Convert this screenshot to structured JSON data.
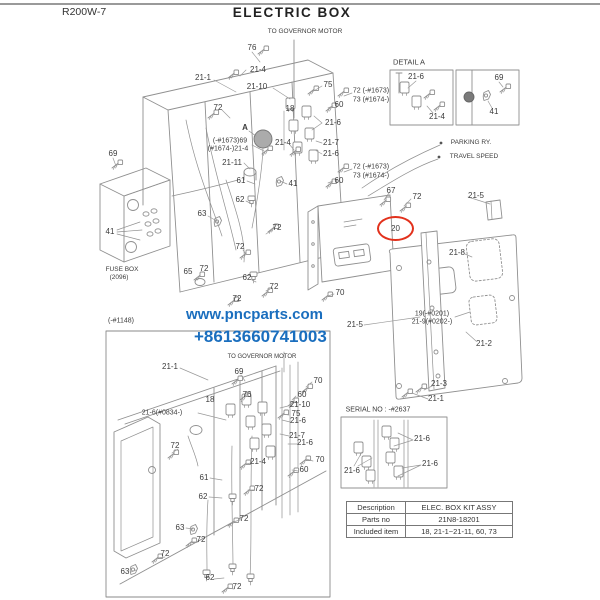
{
  "header": {
    "model": "R200W-7",
    "title": "ELECTRIC BOX"
  },
  "watermark": {
    "line1": "www.pncparts.com",
    "line2": "+8613660741003",
    "color": "#1a6ebe"
  },
  "highlight": {
    "text": "20",
    "color": "#e2311c"
  },
  "table": {
    "rows": [
      {
        "label": "Description",
        "value": "ELEC. BOX KIT ASSY"
      },
      {
        "label": "Parts no",
        "value": "21N8-18201"
      },
      {
        "label": "Included item",
        "value": "18, 21-1~21-11, 60, 73"
      }
    ]
  },
  "callouts": [
    {
      "text": "TO GOVERNOR MOTOR",
      "x": 305,
      "y": 32,
      "size": 6.5
    },
    {
      "text": "76",
      "x": 252,
      "y": 48
    },
    {
      "text": "21-4",
      "x": 258,
      "y": 70
    },
    {
      "text": "21-1",
      "x": 203,
      "y": 78
    },
    {
      "text": "21-10",
      "x": 257,
      "y": 87
    },
    {
      "text": "75",
      "x": 328,
      "y": 85
    },
    {
      "text": "72 (-#1673)",
      "x": 371,
      "y": 91,
      "size": 7
    },
    {
      "text": "73 (#1674-)",
      "x": 371,
      "y": 100,
      "size": 7
    },
    {
      "text": "60",
      "x": 339,
      "y": 105
    },
    {
      "text": "72",
      "x": 218,
      "y": 108
    },
    {
      "text": "18",
      "x": 290,
      "y": 109
    },
    {
      "text": "21-6",
      "x": 333,
      "y": 123
    },
    {
      "text": "A",
      "x": 245,
      "y": 128,
      "bold": true
    },
    {
      "text": "(-#1673)69",
      "x": 230,
      "y": 141,
      "size": 7
    },
    {
      "text": "(#1674-)21-4",
      "x": 228,
      "y": 149,
      "size": 7
    },
    {
      "text": "21-4",
      "x": 283,
      "y": 143
    },
    {
      "text": "21-7",
      "x": 331,
      "y": 143
    },
    {
      "text": "21-6",
      "x": 331,
      "y": 154
    },
    {
      "text": "21-11",
      "x": 232,
      "y": 163
    },
    {
      "text": "DETAIL A",
      "x": 409,
      "y": 62,
      "size": 7.5
    },
    {
      "text": "21-6",
      "x": 416,
      "y": 77
    },
    {
      "text": "21-4",
      "x": 437,
      "y": 117
    },
    {
      "text": "69",
      "x": 499,
      "y": 78
    },
    {
      "text": "41",
      "x": 494,
      "y": 112
    },
    {
      "text": "PARKING RY.",
      "x": 471,
      "y": 143,
      "size": 6.5
    },
    {
      "text": "TRAVEL SPEED",
      "x": 474,
      "y": 157,
      "size": 6.5
    },
    {
      "text": "69",
      "x": 113,
      "y": 154
    },
    {
      "text": "61",
      "x": 241,
      "y": 181
    },
    {
      "text": "41",
      "x": 293,
      "y": 184
    },
    {
      "text": "72 (-#1673)",
      "x": 371,
      "y": 167,
      "size": 7
    },
    {
      "text": "73 (#1674-)",
      "x": 371,
      "y": 176,
      "size": 7
    },
    {
      "text": "60",
      "x": 339,
      "y": 181
    },
    {
      "text": "67",
      "x": 391,
      "y": 191
    },
    {
      "text": "72",
      "x": 417,
      "y": 197
    },
    {
      "text": "21-5",
      "x": 476,
      "y": 196
    },
    {
      "text": "62",
      "x": 240,
      "y": 200
    },
    {
      "text": "63",
      "x": 202,
      "y": 214
    },
    {
      "text": "41",
      "x": 110,
      "y": 232
    },
    {
      "text": "72",
      "x": 277,
      "y": 228
    },
    {
      "text": "72",
      "x": 240,
      "y": 247
    },
    {
      "text": "21-8",
      "x": 457,
      "y": 253
    },
    {
      "text": "65",
      "x": 188,
      "y": 272
    },
    {
      "text": "72",
      "x": 204,
      "y": 269
    },
    {
      "text": "FUSE BOX",
      "x": 122,
      "y": 270,
      "size": 6.5
    },
    {
      "text": "(2096)",
      "x": 119,
      "y": 278,
      "size": 6.5
    },
    {
      "text": "62",
      "x": 247,
      "y": 278
    },
    {
      "text": "72",
      "x": 274,
      "y": 287
    },
    {
      "text": "70",
      "x": 340,
      "y": 293
    },
    {
      "text": "72",
      "x": 237,
      "y": 299
    },
    {
      "text": "19(-#0201)",
      "x": 432,
      "y": 314,
      "size": 7
    },
    {
      "text": "21-9(#0202-)",
      "x": 432,
      "y": 322,
      "size": 7
    },
    {
      "text": "21-5",
      "x": 355,
      "y": 325
    },
    {
      "text": "21-2",
      "x": 484,
      "y": 344
    },
    {
      "text": "21-3",
      "x": 439,
      "y": 384
    },
    {
      "text": "21-1",
      "x": 436,
      "y": 399
    },
    {
      "text": "(-#1148)",
      "x": 121,
      "y": 321,
      "size": 7
    },
    {
      "text": "TO GOVERNOR MOTOR",
      "x": 262,
      "y": 357,
      "size": 6
    },
    {
      "text": "21-1",
      "x": 170,
      "y": 367
    },
    {
      "text": "69",
      "x": 239,
      "y": 372
    },
    {
      "text": "70",
      "x": 318,
      "y": 381
    },
    {
      "text": "76",
      "x": 247,
      "y": 395
    },
    {
      "text": "18",
      "x": 210,
      "y": 400
    },
    {
      "text": "60",
      "x": 302,
      "y": 395
    },
    {
      "text": "21-10",
      "x": 300,
      "y": 405
    },
    {
      "text": "75",
      "x": 296,
      "y": 414
    },
    {
      "text": "21-6",
      "x": 298,
      "y": 421
    },
    {
      "text": "21-6(#0834-)",
      "x": 162,
      "y": 413,
      "size": 7
    },
    {
      "text": "21-7",
      "x": 297,
      "y": 436
    },
    {
      "text": "21-6",
      "x": 305,
      "y": 443
    },
    {
      "text": "72",
      "x": 175,
      "y": 446
    },
    {
      "text": "21-4",
      "x": 258,
      "y": 462
    },
    {
      "text": "70",
      "x": 320,
      "y": 460
    },
    {
      "text": "60",
      "x": 304,
      "y": 470
    },
    {
      "text": "61",
      "x": 204,
      "y": 478
    },
    {
      "text": "72",
      "x": 259,
      "y": 489
    },
    {
      "text": "62",
      "x": 203,
      "y": 497
    },
    {
      "text": "72",
      "x": 244,
      "y": 519
    },
    {
      "text": "63",
      "x": 180,
      "y": 528
    },
    {
      "text": "72",
      "x": 201,
      "y": 540
    },
    {
      "text": "72",
      "x": 165,
      "y": 554
    },
    {
      "text": "63",
      "x": 125,
      "y": 572
    },
    {
      "text": "62",
      "x": 210,
      "y": 578
    },
    {
      "text": "72",
      "x": 237,
      "y": 587
    },
    {
      "text": "SERIAL NO : -#2637",
      "x": 378,
      "y": 410,
      "size": 7
    },
    {
      "text": "21-6",
      "x": 422,
      "y": 439
    },
    {
      "text": "21-6",
      "x": 430,
      "y": 464
    },
    {
      "text": "21-6",
      "x": 352,
      "y": 471
    }
  ]
}
